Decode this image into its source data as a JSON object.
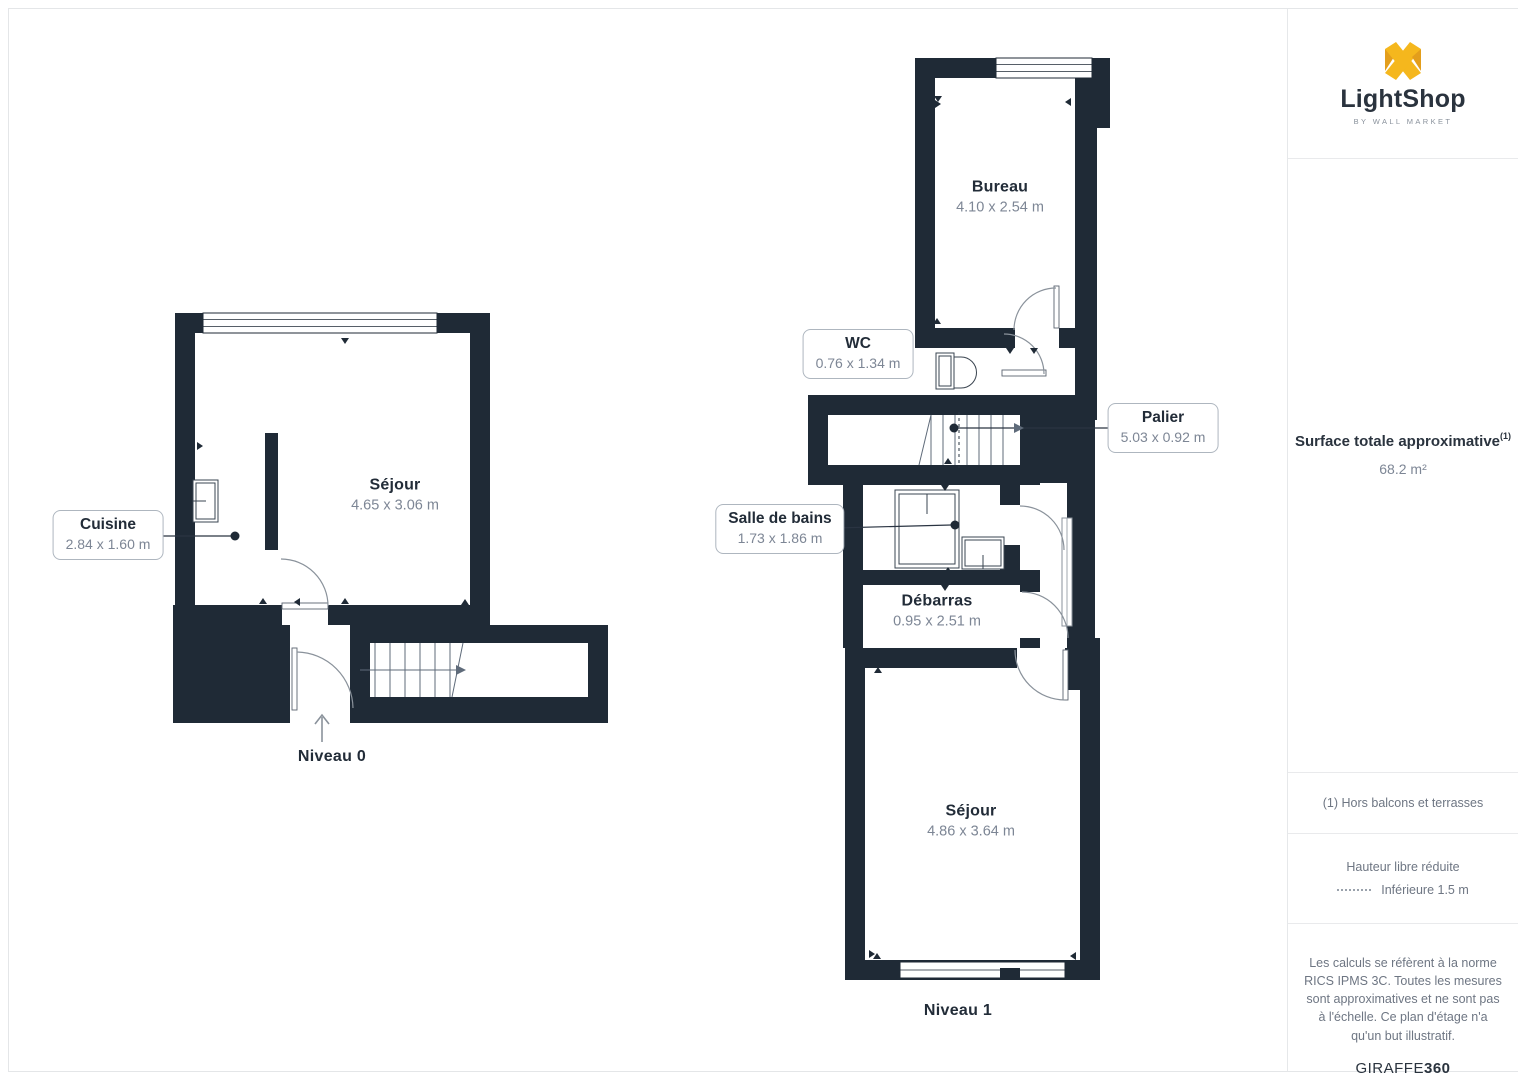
{
  "branding": {
    "logo_text": "LightShop",
    "logo_tagline": "BY WALL MARKET",
    "accent_color": "#F5B71D",
    "accent_dark": "#E39E1C"
  },
  "sidebar": {
    "surface_title": "Surface totale approximative",
    "surface_sup": "(1)",
    "surface_value": "68.2 m²",
    "footnote": "(1) Hors balcons et terrasses",
    "legend_title": "Hauteur libre réduite",
    "legend_item": "Inférieure 1.5 m",
    "legal": "Les calculs se réfèrent à la norme RICS IPMS 3C. Toutes les mesures sont approximatives et ne sont pas à l'échelle. Ce plan d'étage n'a qu'un but illustratif.",
    "brand_footer_regular": "GIRAFFE",
    "brand_footer_bold": "360"
  },
  "floors": [
    {
      "name": "Niveau 0",
      "rooms": [
        {
          "name": "Séjour",
          "dims": "4.65 x 3.06 m"
        },
        {
          "name": "Cuisine",
          "dims": "2.84 x 1.60 m"
        }
      ]
    },
    {
      "name": "Niveau 1",
      "rooms": [
        {
          "name": "Bureau",
          "dims": "4.10 x 2.54 m"
        },
        {
          "name": "WC",
          "dims": "0.76 x 1.34 m"
        },
        {
          "name": "Palier",
          "dims": "5.03 x 0.92 m"
        },
        {
          "name": "Salle de bains",
          "dims": "1.73 x 1.86 m"
        },
        {
          "name": "Débarras",
          "dims": "0.95 x 2.51 m"
        },
        {
          "name": "Séjour",
          "dims": "4.86 x 3.64 m"
        }
      ]
    }
  ],
  "colors": {
    "wall": "#1F2A36",
    "dim_text": "#7D8695",
    "line_gray": "#8A929B"
  }
}
